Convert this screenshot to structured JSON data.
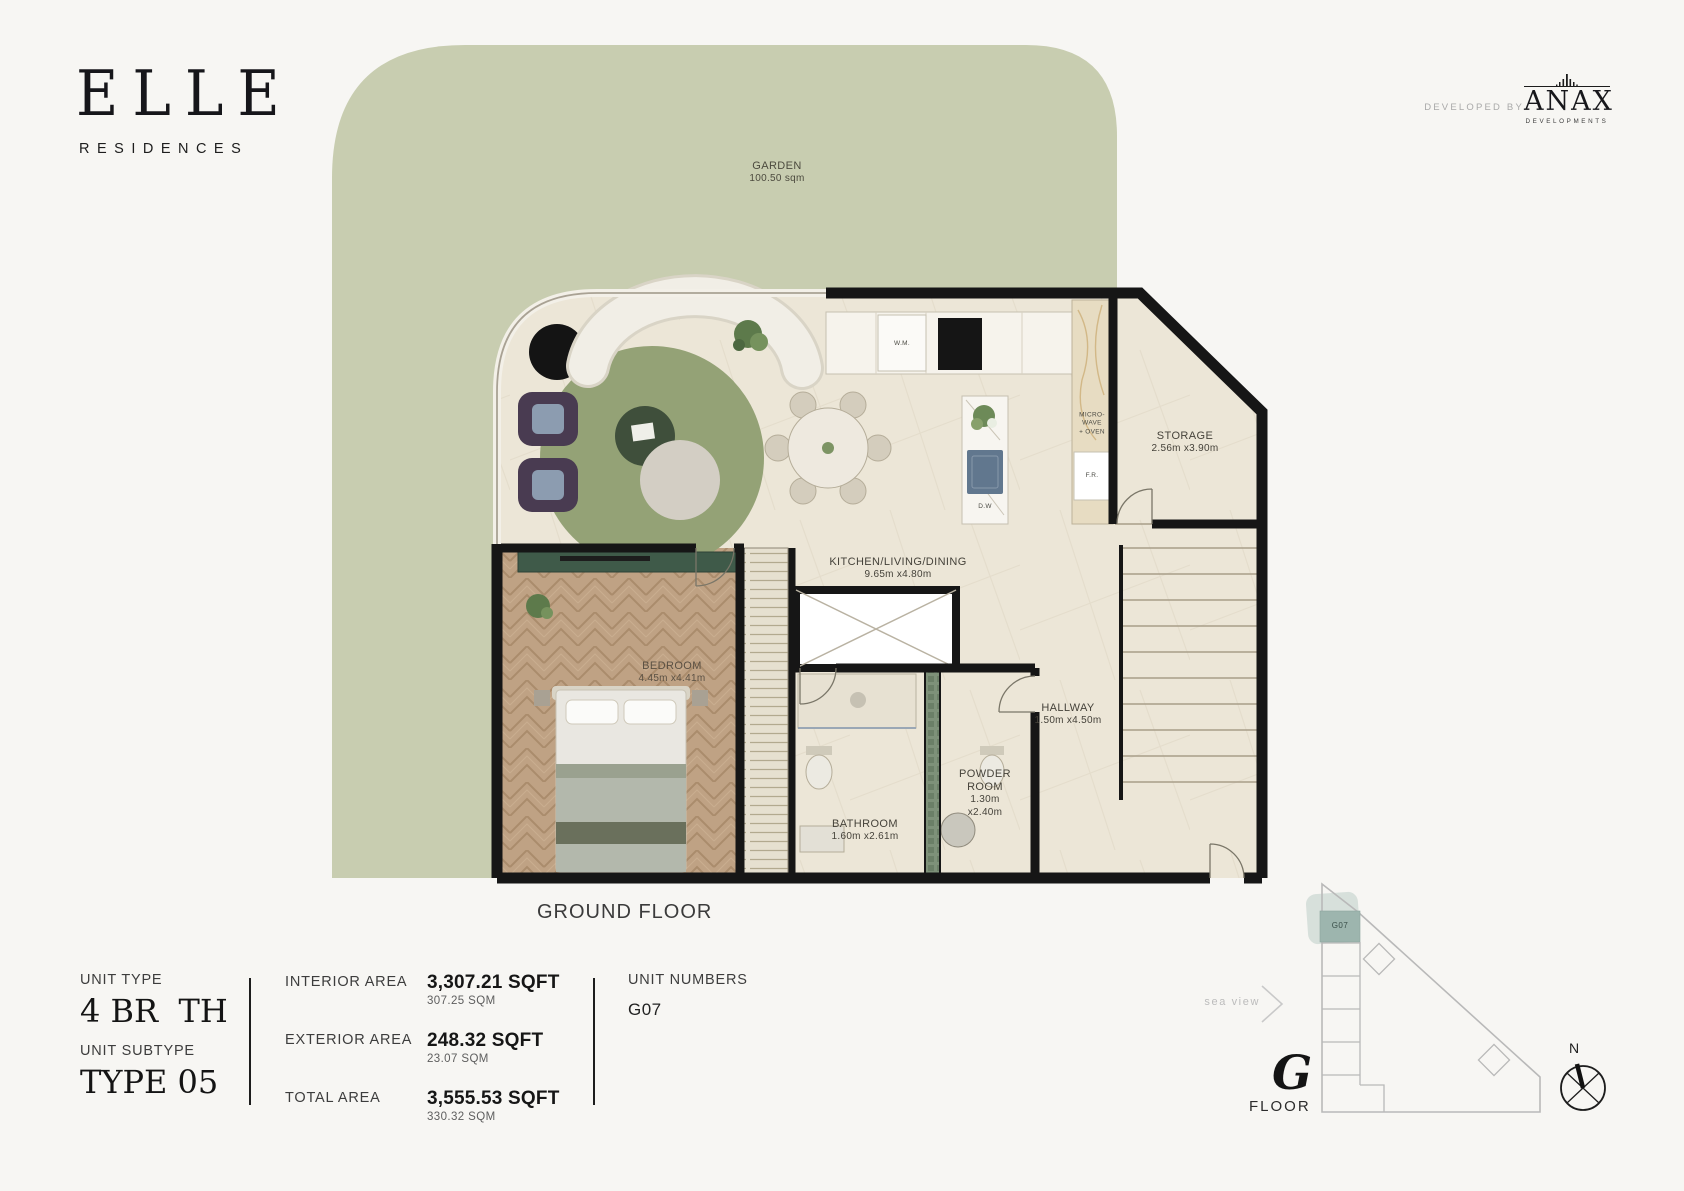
{
  "brand": {
    "logo": "ELLE",
    "sub": "RESIDENCES"
  },
  "developer": {
    "prefix": "DEVELOPED BY",
    "name": "ANAX",
    "sub": "DEVELOPMENTS"
  },
  "plan": {
    "caption": "GROUND FLOOR",
    "garden": {
      "name": "GARDEN",
      "size": "100.50 sqm"
    },
    "kitchen": {
      "name": "KITCHEN/LIVING/DINING",
      "size": "9.65m x4.80m"
    },
    "storage": {
      "name": "STORAGE",
      "size": "2.56m x3.90m"
    },
    "bedroom": {
      "name": "BEDROOM",
      "size": "4.45m x4.41m"
    },
    "hallway": {
      "name": "HALLWAY",
      "size": "1.50m x4.50m"
    },
    "powder": {
      "name": "POWDER ROOM",
      "size": "1.30m x2.40m"
    },
    "bathroom": {
      "name": "BATHROOM",
      "size": "1.60m x2.61m"
    },
    "appliances": {
      "wm": "W.M.",
      "micro_l1": "MICRO-",
      "micro_l2": "WAVE",
      "micro_l3": "+ OVEN",
      "fr": "F.R.",
      "dw": "D.W"
    }
  },
  "details": {
    "unit_type_label": "UNIT TYPE",
    "unit_type_value": "4 BR  TH",
    "unit_subtype_label": "UNIT SUBTYPE",
    "unit_subtype_value": "TYPE 05",
    "areas": [
      {
        "label": "INTERIOR AREA",
        "sqft": "3,307.21 SQFT",
        "sqm": "307.25 SQM"
      },
      {
        "label": "EXTERIOR AREA",
        "sqft": "248.32 SQFT",
        "sqm": "23.07 SQM"
      },
      {
        "label": "TOTAL AREA",
        "sqft": "3,555.53 SQFT",
        "sqm": "330.32 SQM"
      }
    ],
    "unit_numbers_label": "UNIT NUMBERS",
    "unit_numbers_value": "G07"
  },
  "keyplan": {
    "sea_view": "sea view",
    "unit_label": "G07",
    "floor_letter": "G",
    "floor_word": "FLOOR",
    "north": "N",
    "highlight_color": "#9db5ae"
  },
  "colors": {
    "garden": "#c8cdb0",
    "floor": "#ece6d7",
    "bedroom_wood": "#bfa284",
    "wall": "#161616",
    "rug": "#94a276",
    "keyplan_highlight": "#9db5ae"
  }
}
